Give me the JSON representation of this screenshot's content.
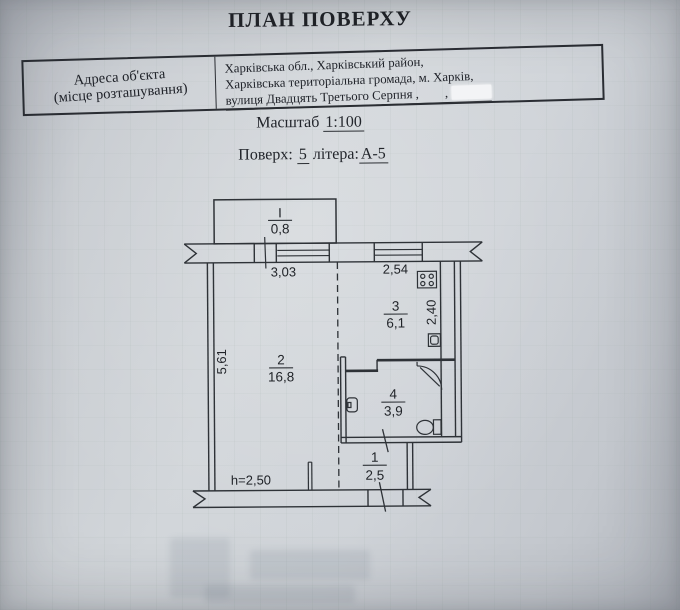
{
  "document": {
    "title": "ПЛАН ПОВЕРХУ",
    "scale_label": "Масштаб",
    "scale_value": "1:100",
    "floor_label": "Поверх:",
    "floor_value": "5",
    "letter_label": "літера:",
    "letter_value": "А-5"
  },
  "address_table": {
    "label_line1": "Адреса об'єкта",
    "label_line2": "(місце розташування)",
    "value_line1": "Харківська обл., Харківський район,",
    "value_line2": "Харківська територіальна громада, м. Харків,",
    "value_line3": "вулиця Двадцять Третього Серпня ,",
    "value_line3_tail": ","
  },
  "plan": {
    "balcony": {
      "num": "I",
      "area": "0,8"
    },
    "rooms": [
      {
        "name": "corridor",
        "num": "1",
        "area": "2,5"
      },
      {
        "name": "living-room",
        "num": "2",
        "area": "16,8"
      },
      {
        "name": "kitchen",
        "num": "3",
        "area": "6,1"
      },
      {
        "name": "bathroom",
        "num": "4",
        "area": "3,9"
      }
    ],
    "dimensions": {
      "room2_width": "3,03",
      "kitchen_width": "2,54",
      "room2_depth": "5,61",
      "kitchen_depth": "2,40",
      "ceiling_height": "h=2,50"
    },
    "icons": [
      "stove-icon",
      "kitchen-sink-icon",
      "washbasin-icon",
      "shower-icon",
      "toilet-icon"
    ],
    "colors": {
      "paper": "#ccd0d5",
      "ink": "#2e3237",
      "redaction": "#f3f4f6"
    }
  }
}
